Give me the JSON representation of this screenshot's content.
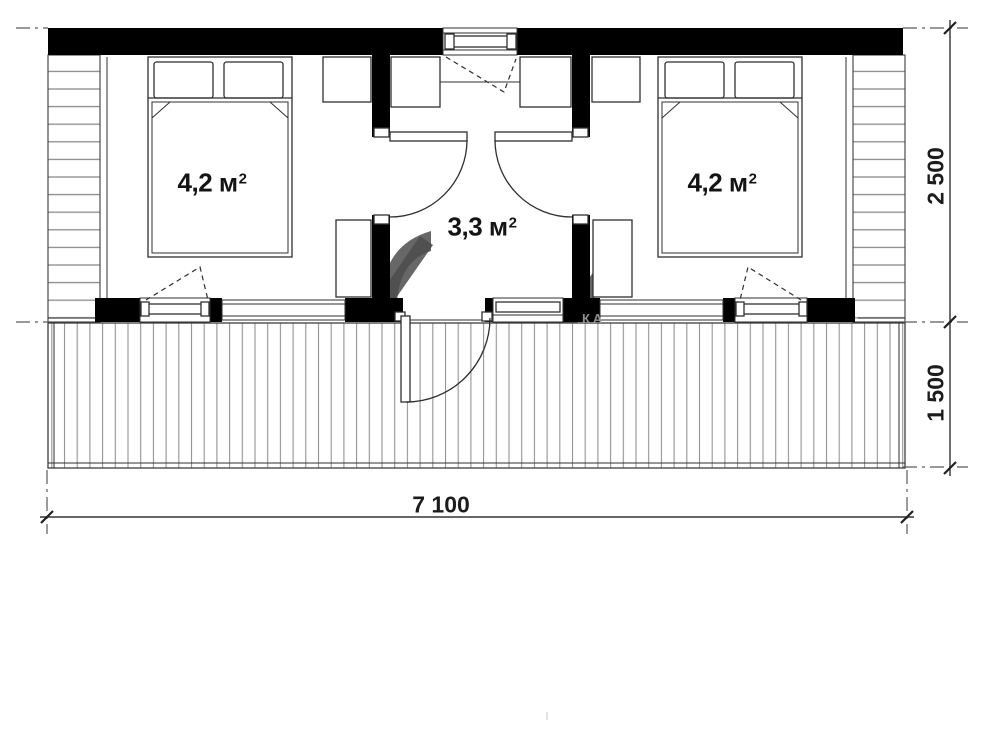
{
  "plan": {
    "rooms": [
      {
        "name": "bedroom-left",
        "area_main": "4,2 м",
        "area_sup": "2"
      },
      {
        "name": "hall-center",
        "area_main": "3,3 м",
        "area_sup": "2"
      },
      {
        "name": "bedroom-right",
        "area_main": "4,2 м",
        "area_sup": "2"
      }
    ],
    "dimensions": [
      {
        "name": "house-depth",
        "value": "2 500"
      },
      {
        "name": "terrace-depth",
        "value": "1 500"
      },
      {
        "name": "total-width",
        "value": "7 100"
      }
    ],
    "watermark": "КА",
    "colors": {
      "walls": "#000000",
      "outline": "#2f2f2f",
      "hatch": "#8a8a8a",
      "decking": "#949494",
      "dimension_text": "#1c1c1c",
      "watermark_gray": "#4c4c4c",
      "watermark_text": "#9e9e9e"
    }
  }
}
